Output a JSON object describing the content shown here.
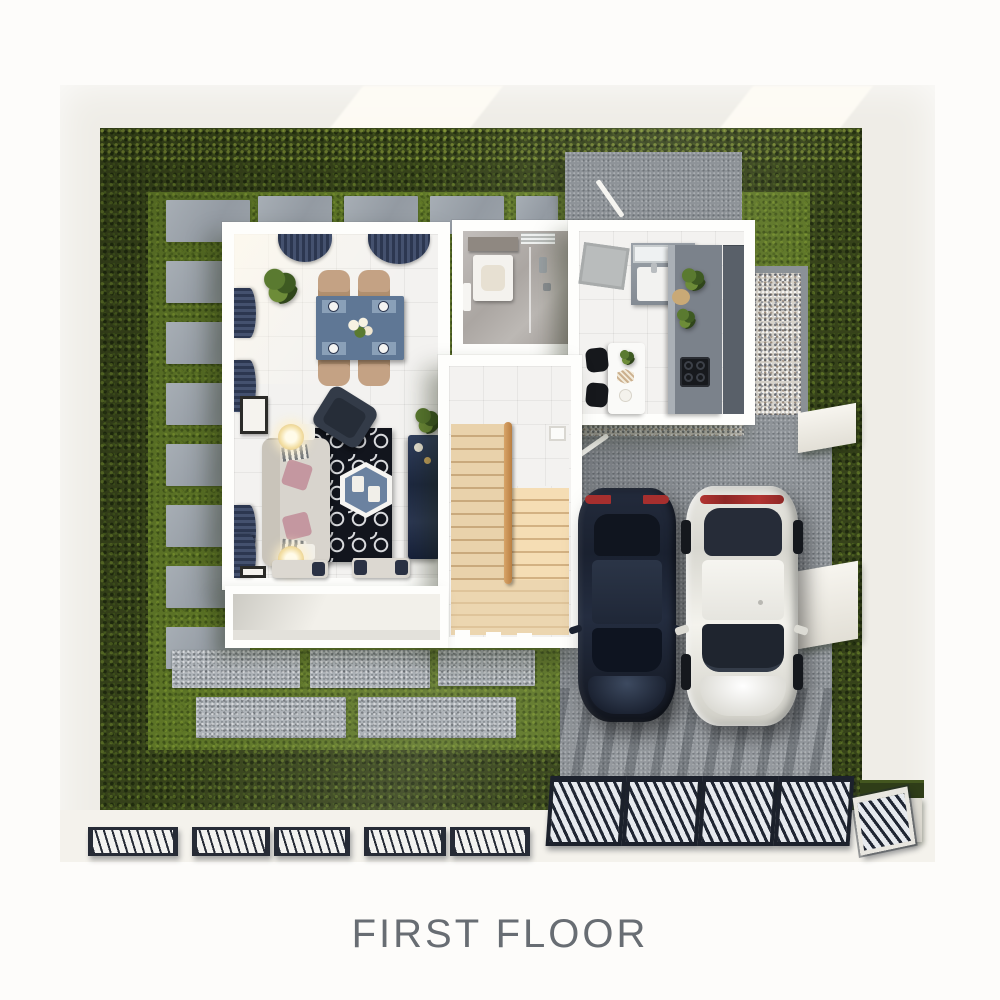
{
  "title": {
    "text": "FIRST FLOOR",
    "color": "#686d73"
  },
  "palette": {
    "page_bg": "#fdfcfa",
    "perimeter_wall": "#efede7",
    "hedge_green": "#36421a",
    "lawn_green": "#5e7627",
    "stepping_stone_gray": "#9aa1a8",
    "paver_speckled_gray": "#aeb3b8",
    "driveway_gray": "#8e9398",
    "gravel_light": "#d6d2ca",
    "house_wall_white": "#fefefc",
    "tile_floor": "#f3f2f0",
    "stair_wood": "#e4c89e",
    "bathroom_marble": "#b7b3af",
    "kitchen_counter_gray": "#848b93",
    "dining_table_blue": "#5f7795",
    "chair_tan": "#c4a284",
    "sofa_greige": "#d8d4cd",
    "rug_navy": "#12151d",
    "armchair_navy": "#333b48",
    "tv_console_blue_marble": "#2b3752",
    "curtain_navy": "#2f3a52",
    "pillow_pink": "#c497a0",
    "car_dark_navy": "#1e2635",
    "car_white": "#eeede7",
    "taillight_red": "#b23432",
    "fence_dark": "#252a36",
    "gate_slat_light": "#e6e9ee"
  },
  "scene": {
    "areas": [
      "front-lawn",
      "hedge-border",
      "stepping-stones",
      "paver-path",
      "rear-concrete-pad",
      "gravel-strip",
      "driveway",
      "front-porch"
    ],
    "rooms": [
      "living-room",
      "dining-area",
      "bathroom",
      "kitchen",
      "stair-hall"
    ],
    "furniture": [
      "dining-table",
      "dining-chairs",
      "corner-plant",
      "sofa",
      "hex-coffee-table",
      "area-rug",
      "armchair",
      "tv-console",
      "floor-lamps",
      "benches",
      "wall-art",
      "kitchen-island",
      "bar-stools",
      "cooktop",
      "kitchen-sink",
      "vanity",
      "shower",
      "staircase",
      "stair-handrail",
      "doormat"
    ],
    "vehicles": [
      "dark-sedan",
      "white-sedan"
    ],
    "boundary": [
      "perimeter-wall",
      "front-fence",
      "driveway-gate",
      "pedestrian-gate",
      "gate-pillar",
      "planter-box",
      "driveway-piers"
    ]
  }
}
